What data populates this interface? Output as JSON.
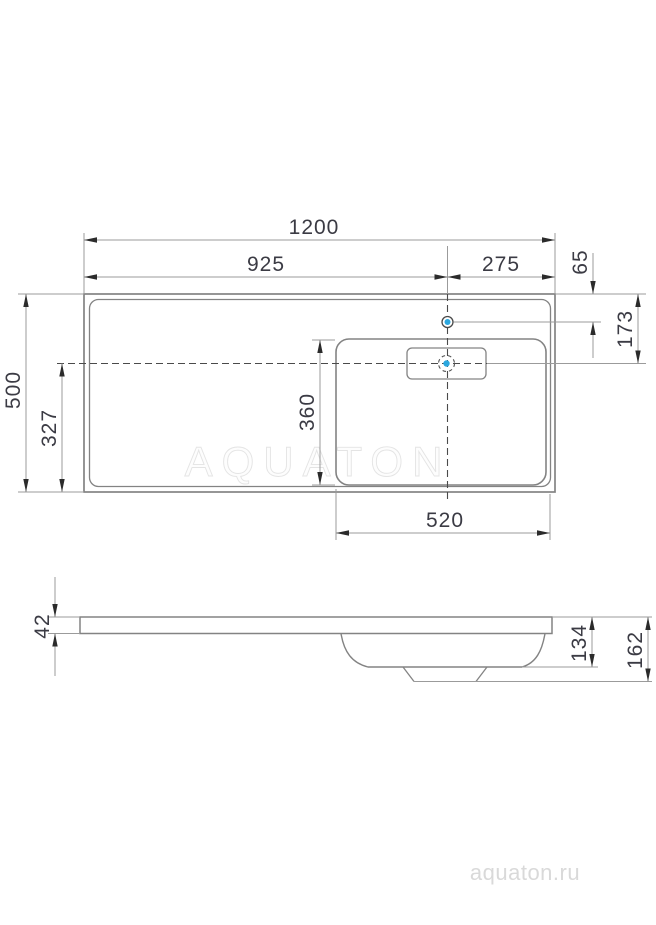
{
  "watermark": "AQUATON",
  "brand": "aquaton.ru",
  "colors": {
    "accent_blue": "#2ba7df",
    "outline_gray": "#838383",
    "dim_line_gray": "#9b9b9b",
    "text_dark": "#3b3b44",
    "watermark_gray": "#e4e4e4",
    "brand_gray": "#d9d9d9"
  },
  "top_view": {
    "overall_width": "1200",
    "left_edge_to_faucet": "925",
    "faucet_to_right_edge": "275",
    "back_edge_to_faucet": "65",
    "back_edge_to_overflow": "173",
    "overall_depth": "500",
    "front_edge_to_overflow": "327",
    "basin_depth": "360",
    "basin_width": "520"
  },
  "side_view": {
    "slab_thickness": "42",
    "bowl_depth": "134",
    "overall_height": "162"
  }
}
